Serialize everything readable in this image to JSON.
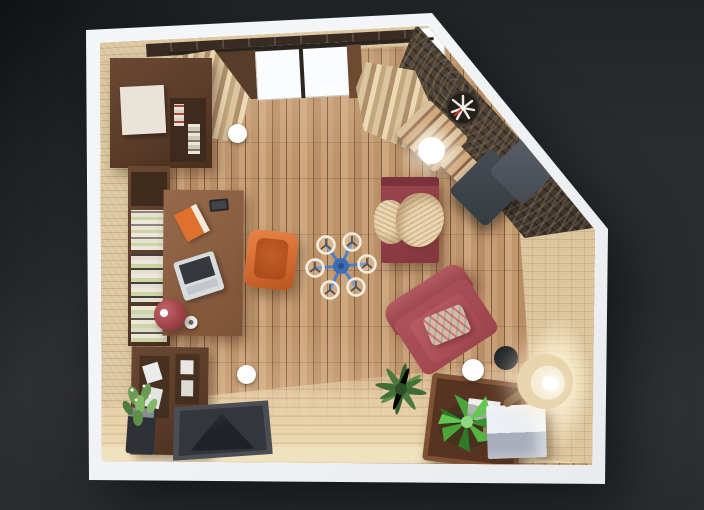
{
  "scene": {
    "type": "3d-floorplan-top-down-render",
    "room_label": "Living room with home office",
    "objects": [
      {
        "id": "wall-unit",
        "label": "Wardrobe wall unit",
        "color": "#5a3c29"
      },
      {
        "id": "bookshelf",
        "label": "Bookshelf with books",
        "color": "#583a27"
      },
      {
        "id": "desk",
        "label": "Writing desk",
        "color": "#8a5e40"
      },
      {
        "id": "laptop",
        "label": "Laptop",
        "color": "#d9dcde"
      },
      {
        "id": "book",
        "label": "Orange book",
        "color": "#e0702e"
      },
      {
        "id": "smartphone",
        "label": "Smartphone",
        "color": "#26282c"
      },
      {
        "id": "mug",
        "label": "Mug",
        "color": "#f2f0ec"
      },
      {
        "id": "red-planter",
        "label": "Red planter",
        "color": "#9c4046"
      },
      {
        "id": "orange-armchair",
        "label": "Orange armchair",
        "color": "#d96f36"
      },
      {
        "id": "sideboard",
        "label": "Sideboard",
        "color": "#573a27"
      },
      {
        "id": "potted-plant",
        "label": "Potted plant",
        "color": "#6a9a55"
      },
      {
        "id": "doormat",
        "label": "Doormat",
        "color": "#43474c"
      },
      {
        "id": "curtain-left",
        "label": "Curtain",
        "color": "#d6bd95"
      },
      {
        "id": "curtain-right",
        "label": "Curtain",
        "color": "#d6bd95"
      },
      {
        "id": "window",
        "label": "Window",
        "color": "#fbfcfd"
      },
      {
        "id": "stone-wall",
        "label": "Stone accent wall",
        "color": "#4a4036"
      },
      {
        "id": "wall-clock",
        "label": "Wall clock",
        "color": "#241f1a"
      },
      {
        "id": "bench",
        "label": "Slatted bench",
        "color": "#cfa87c"
      },
      {
        "id": "bench-lamp",
        "label": "Glowing table lamp",
        "color": "#ffffff"
      },
      {
        "id": "lounge-chair",
        "label": "Gray lounge chair",
        "color": "#454b51"
      },
      {
        "id": "daybed",
        "label": "Daybed",
        "color": "#8e3e45"
      },
      {
        "id": "blanket",
        "label": "Throw blanket",
        "color": "#ead7b2"
      },
      {
        "id": "armchair",
        "label": "Red armchair",
        "color": "#a84e56"
      },
      {
        "id": "pillow",
        "label": "Patterned pillow",
        "color": "#d8b8aa"
      },
      {
        "id": "palm-plant",
        "label": "Palm plant",
        "color": "#4c7a3c"
      },
      {
        "id": "coffee-table",
        "label": "Coffee table",
        "color": "#6a4129"
      },
      {
        "id": "bright-plant",
        "label": "Areca plant",
        "color": "#49a63b"
      },
      {
        "id": "cube-ottoman",
        "label": "Cube ottoman",
        "color": "#b9bfc9"
      },
      {
        "id": "floor-lamp",
        "label": "Floor lamp",
        "color": "#f0e2c2"
      },
      {
        "id": "ceiling-fan",
        "label": "Ceiling fan",
        "color": "#3c6cb4"
      },
      {
        "id": "ceiling-light-1",
        "label": "Ceiling spotlight",
        "color": "#ffffff"
      },
      {
        "id": "ceiling-light-2",
        "label": "Ceiling spotlight",
        "color": "#ffffff"
      },
      {
        "id": "ceiling-light-3",
        "label": "Ceiling spotlight",
        "color": "#ffffff"
      }
    ]
  },
  "palette": {
    "bg": "#2a2c2f",
    "bg_dark": "#15181c",
    "wall_white": "#f4f5f7",
    "floor": "#c0966d",
    "floor_light": "#e9d4ab",
    "wall_face": "#dcc69e",
    "stone": "#4a4036",
    "walnut": "#5a3c29",
    "desk_wood": "#8a5e40",
    "white_door": "#eae3d7",
    "daybed": "#8e3e45",
    "armchair": "#a84e56",
    "blanket": "#ead7b2",
    "orange": "#d96f36",
    "gray_chair": "#454b51",
    "mat_dark": "#1f2226",
    "cube_top": "#eceff4",
    "cube_side": "#a8aebb",
    "lamp_shade": "#f0e2c2",
    "plant_dark": "#4c7a3c",
    "plant_bright": "#49a63b",
    "fan_blue": "#3c6cb4",
    "curtain": "#d6bd95",
    "book_green": "#cdd5a5"
  }
}
